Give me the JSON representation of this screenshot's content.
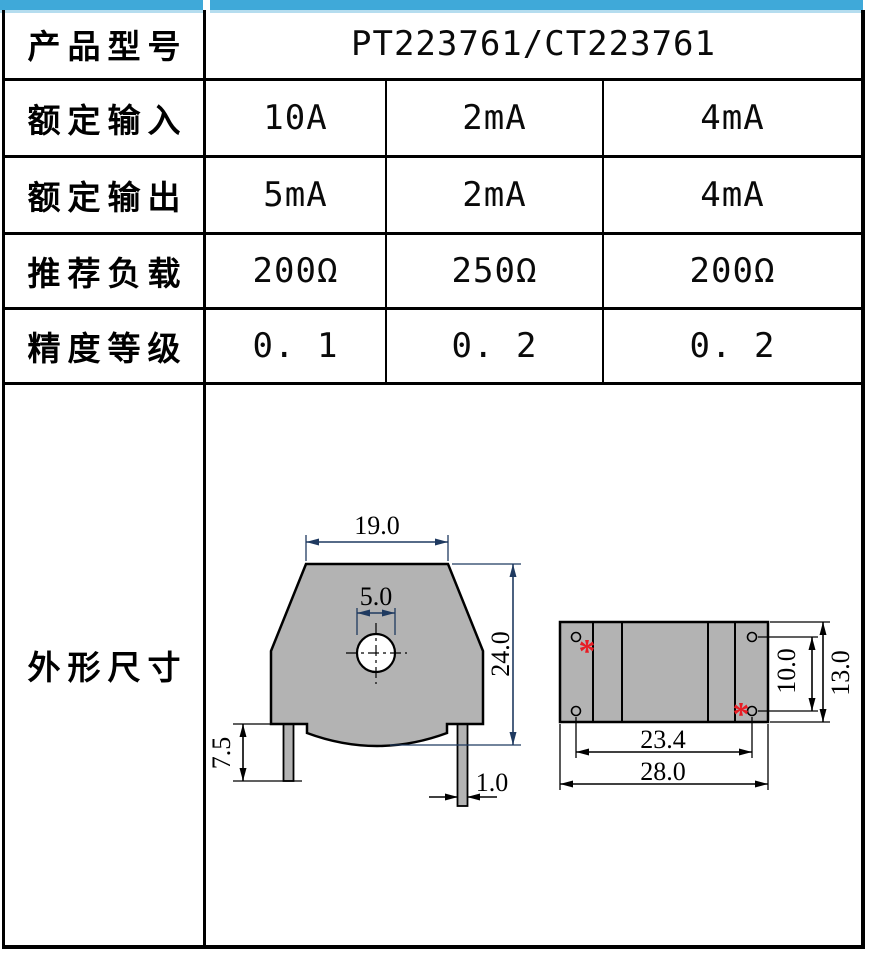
{
  "colors": {
    "accent_blue": "#3fa9d9",
    "accent_blue_light": "#b5ddef",
    "body_gray": "#b3b3b3",
    "dim_navy": "#1f3a60",
    "marker_red": "#e81c24",
    "line_black": "#000000"
  },
  "table": {
    "rows": [
      {
        "label": "产品型号",
        "value": "PT223761/CT223761"
      },
      {
        "label": "额定输入",
        "values": [
          "10A",
          "2mA",
          "4mA"
        ]
      },
      {
        "label": "额定输出",
        "values": [
          "5mA",
          "2mA",
          "4mA"
        ]
      },
      {
        "label": "推荐负载",
        "values": [
          "200Ω",
          "250Ω",
          "200Ω"
        ]
      },
      {
        "label": "精度等级",
        "values": [
          "0. 1",
          "0. 2",
          "0. 2"
        ]
      },
      {
        "label": "外形尺寸"
      }
    ]
  },
  "drawing": {
    "front_view": {
      "top_width": "19.0",
      "hole_width": "5.0",
      "height": "24.0",
      "pin_length": "7.5",
      "pin_width": "1.0"
    },
    "top_view": {
      "pin_span": "23.4",
      "overall_width": "28.0",
      "pin_row_span": "10.0",
      "overall_depth": "13.0",
      "marker": "*"
    }
  }
}
